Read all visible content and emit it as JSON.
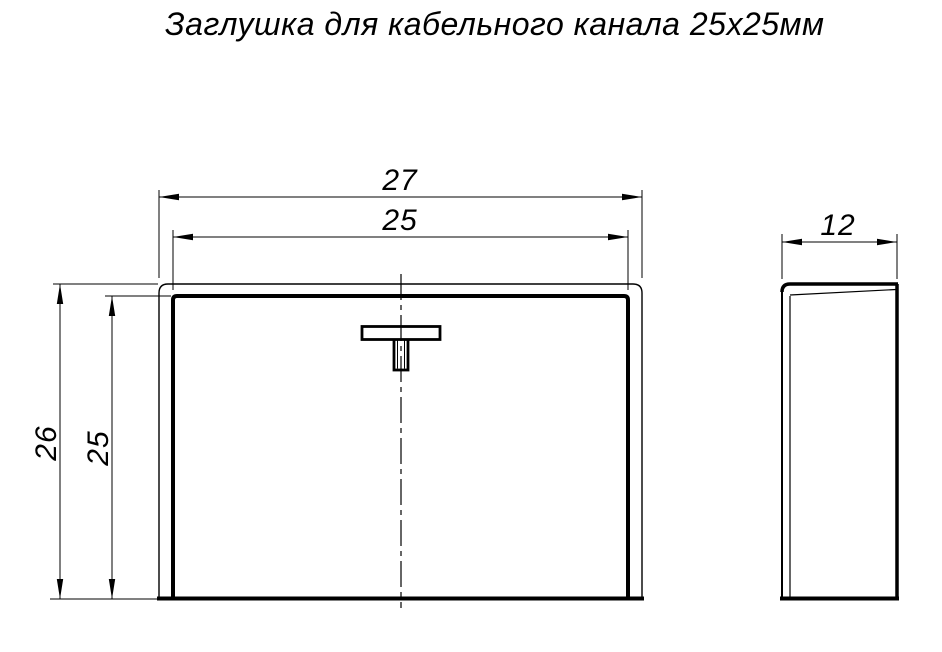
{
  "title": "Заглушка для кабельного канала 25х25мм",
  "dimensions": {
    "front_outer_width": "27",
    "front_inner_width": "25",
    "front_outer_height": "26",
    "front_inner_height": "25",
    "side_depth": "12"
  },
  "colors": {
    "line": "#000000",
    "background": "#ffffff"
  }
}
